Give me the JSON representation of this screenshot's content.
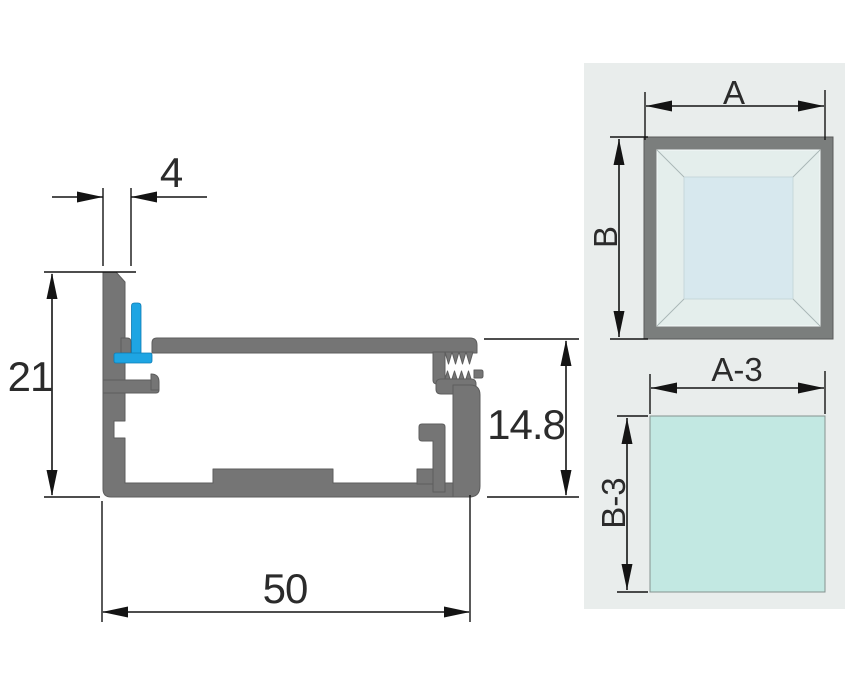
{
  "profile_drawing": {
    "dim_top_width": "4",
    "dim_left_height": "21",
    "dim_right_height": "14.8",
    "dim_bottom_width": "50",
    "colors": {
      "metal": "#757575",
      "gasket_blue": "#1ea5e3",
      "line": "#141414"
    }
  },
  "panel_diagrams": {
    "background": "#e9edec",
    "frame": {
      "width_label": "A",
      "height_label": "B",
      "frame_color": "#7b7e7d",
      "bevel_color": "#e4eeec",
      "glass_color": "#d7e8ee"
    },
    "glass": {
      "width_label": "A-3",
      "height_label": "B-3",
      "fill_color": "#c2e8e2"
    }
  }
}
